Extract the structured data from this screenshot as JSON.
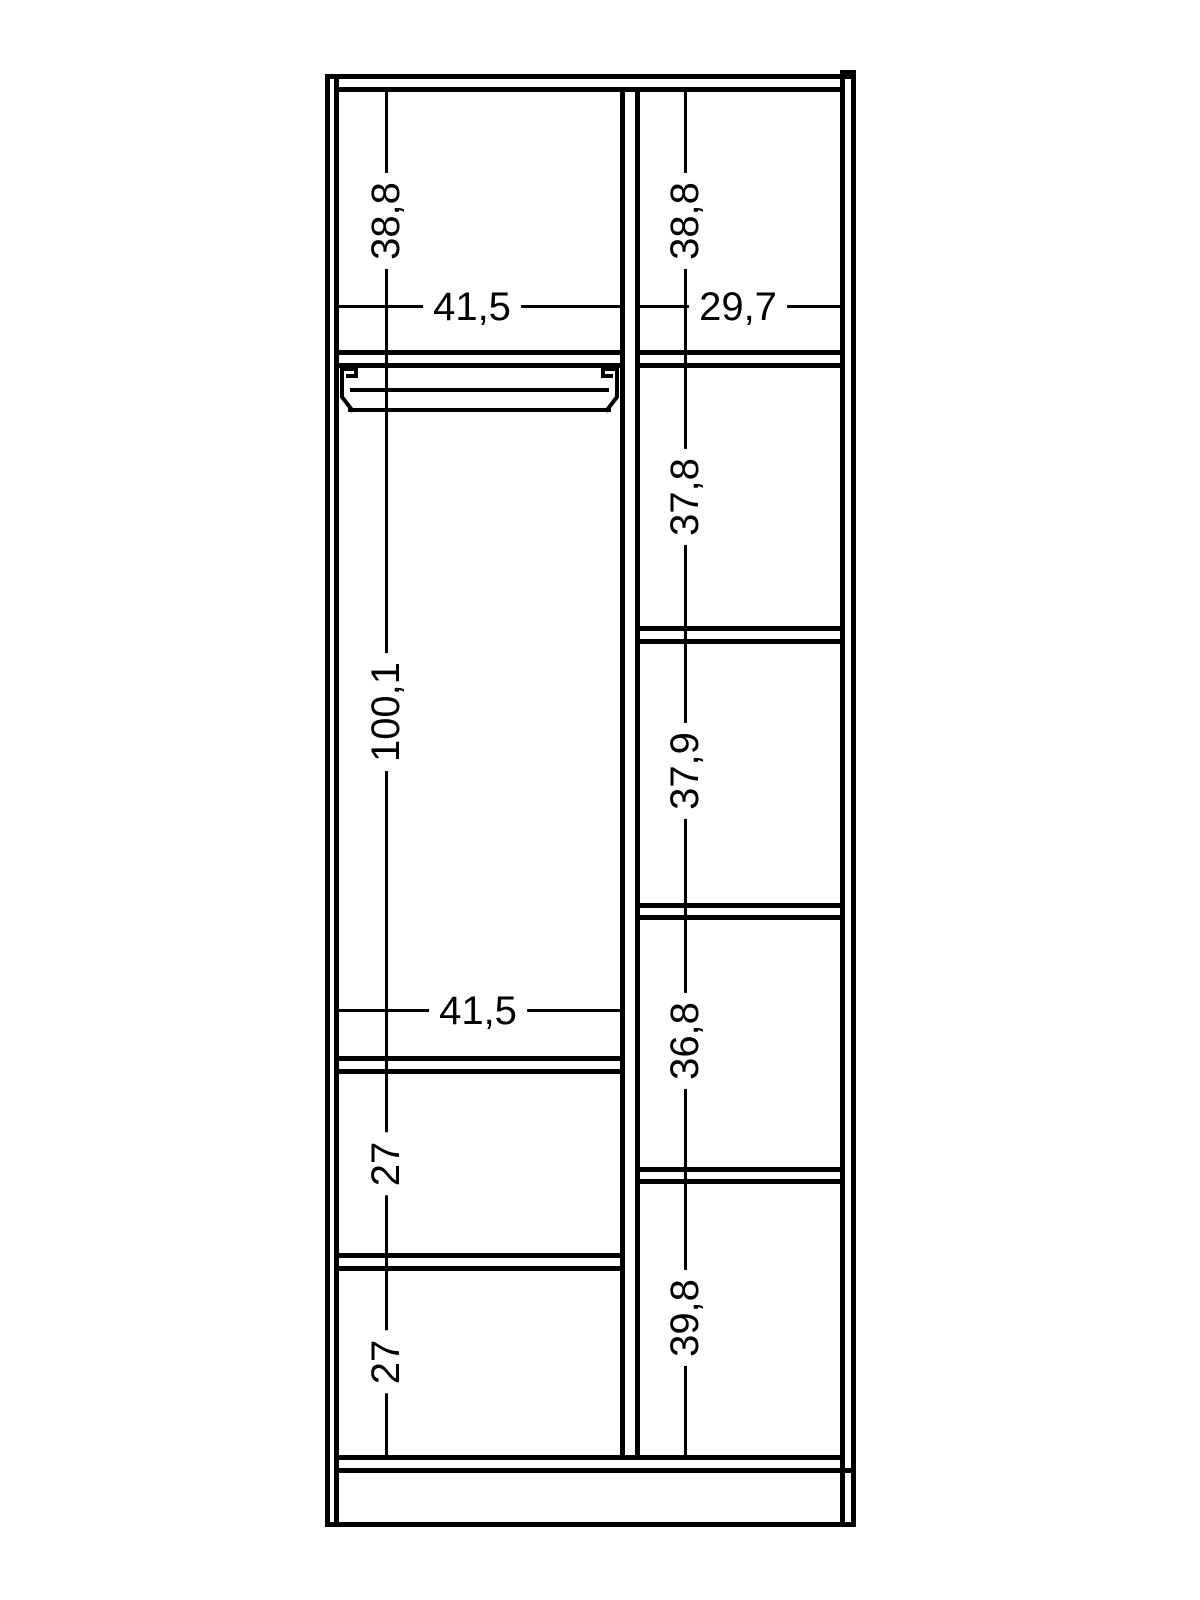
{
  "page": {
    "background_color": "#ffffff",
    "line_color": "#000000"
  },
  "drawing": {
    "type": "furniture-section-dimension-diagram",
    "description": "Wardrobe interior front-section drawing with compartment dimensions (decimal comma values)",
    "labels": {
      "left_top_height": "38,8",
      "left_top_width": "41,5",
      "left_rod_section_height": "100,1",
      "left_mid_width": "41,5",
      "left_drawer1_height": "27",
      "left_drawer2_height": "27",
      "right_top_height": "38,8",
      "right_top_width": "29,7",
      "right_section2_height": "37,8",
      "right_section3_height": "37,9",
      "right_section4_height": "36,8",
      "right_section5_height": "39,8"
    }
  }
}
